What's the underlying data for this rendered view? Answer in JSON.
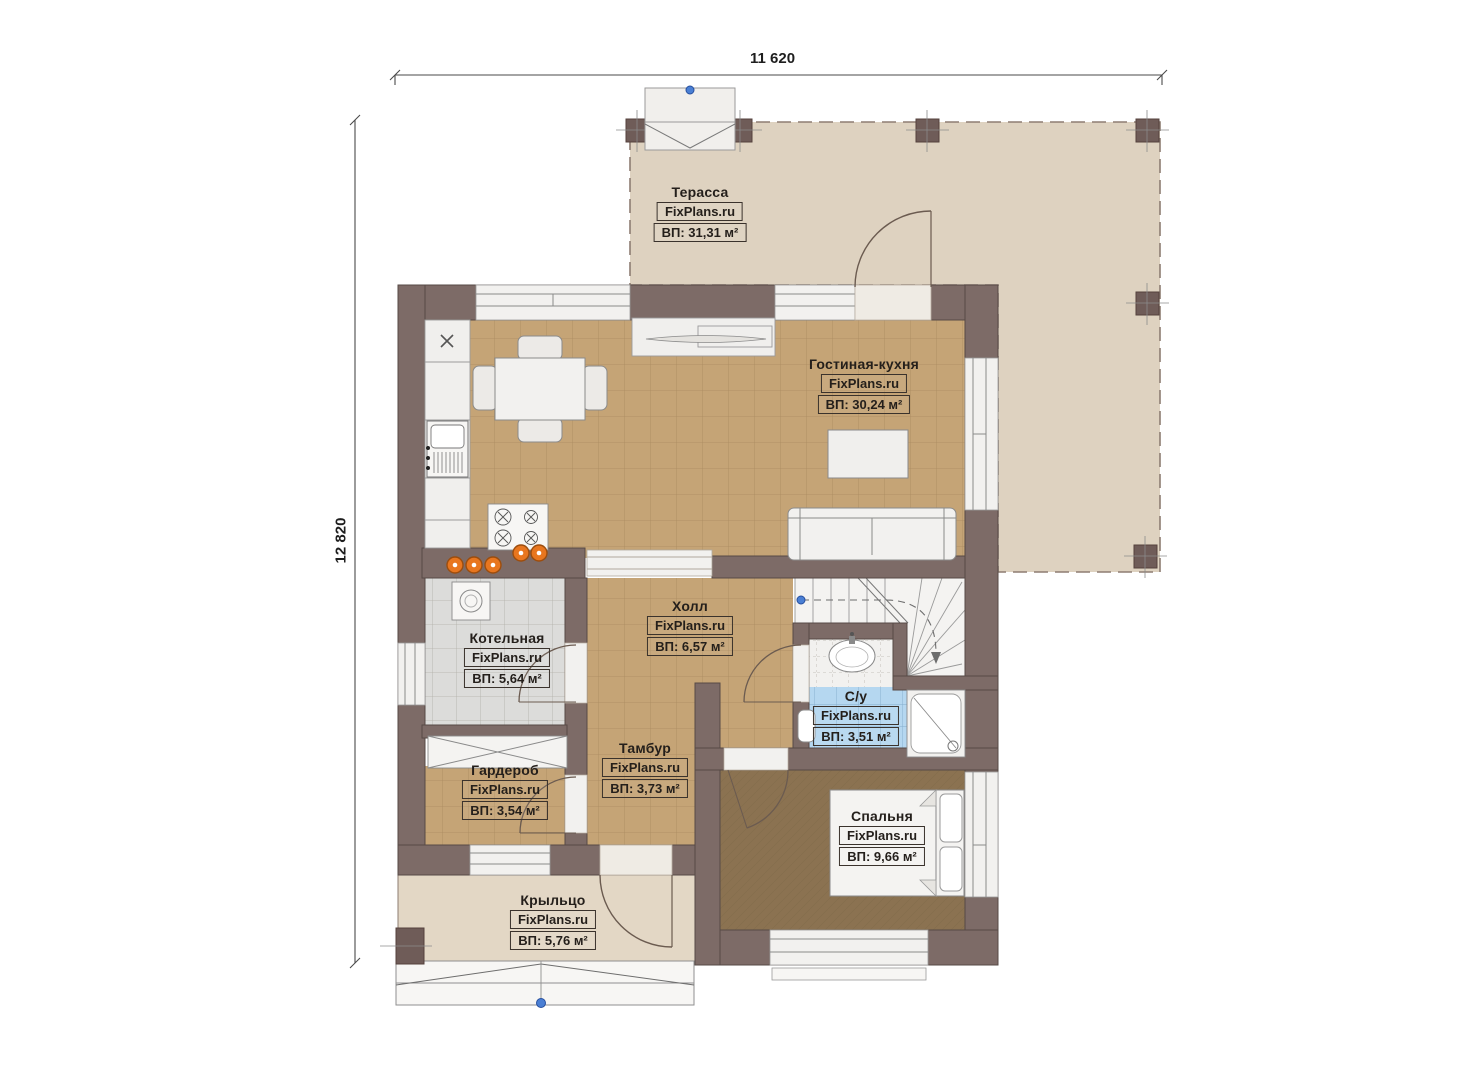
{
  "brand": "FixPlans.ru",
  "dimensions": {
    "width_label": "11 620",
    "height_label": "12 820"
  },
  "rooms": {
    "terrace": {
      "name": "Терасса",
      "area": "ВП: 31,31 м²"
    },
    "living_kitchen": {
      "name": "Гостиная-кухня",
      "area": "ВП: 30,24 м²"
    },
    "boiler": {
      "name": "Котельная",
      "area": "ВП: 5,64 м²"
    },
    "hall": {
      "name": "Холл",
      "area": "ВП: 6,57 м²"
    },
    "bathroom": {
      "name": "С/у",
      "area": "ВП: 3,51 м²"
    },
    "wardrobe": {
      "name": "Гардероб",
      "area": "ВП: 3,54 м²"
    },
    "tambour": {
      "name": "Тамбур",
      "area": "ВП: 3,73 м²"
    },
    "bedroom": {
      "name": "Спальня",
      "area": "ВП: 9,66 м²"
    },
    "porch": {
      "name": "Крыльцо",
      "area": "ВП: 5,76 м²"
    }
  },
  "colors": {
    "wall": "#7d6b67",
    "tile_tan": "#c5a476",
    "tile_gray": "#dcdcda",
    "tile_blue": "#b5d7f0",
    "terrace_floor": "#ded2c0",
    "bedroom_floor": "#8b7251",
    "stool_orange": "#e8761f",
    "marker_blue": "#4a7fd4"
  }
}
